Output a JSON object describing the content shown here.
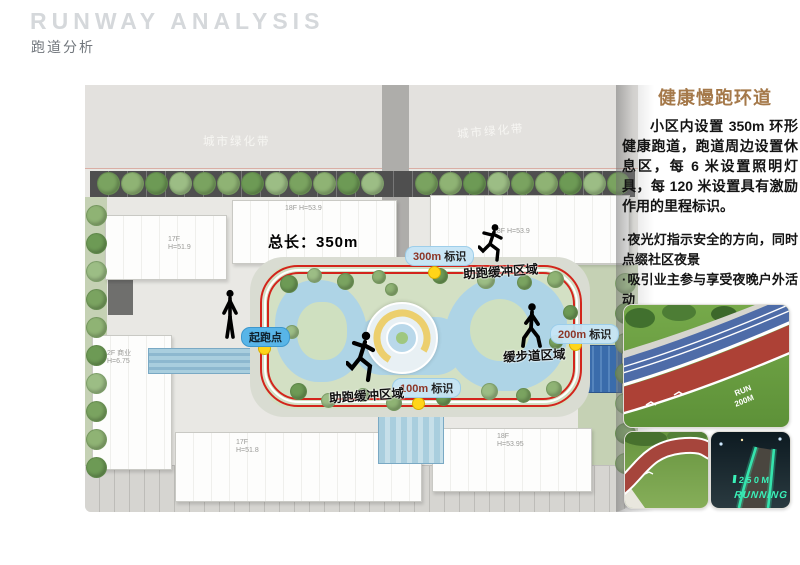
{
  "header": {
    "title_en": "RUNWAY ANALYSIS",
    "title_zh": "跑道分析"
  },
  "map": {
    "greenbelt_left": "城市绿化带",
    "greenbelt_right": "城市绿化带",
    "total_length": "总长：350m",
    "markers": {
      "m300": {
        "value": "300m",
        "text": "标识"
      },
      "m200": {
        "value": "200m",
        "text": "标识"
      },
      "m100": {
        "value": "100m",
        "text": "标识"
      },
      "start": "起跑点"
    },
    "zones": {
      "buffer_top": "助跑缓冲区域",
      "buffer_bottom": "助跑缓冲区域",
      "slow_lane": "缓步道区域"
    },
    "buildings": {
      "top_left": "17F\nH=51.9",
      "top_mid": "18F H=53.9",
      "top_right": "18F H=53.9",
      "left_commercial": "2F 商业\nH=6.75",
      "bottom_left": "17F\nH=51.8",
      "bottom_right": "18F\nH=53.95"
    }
  },
  "sidebar": {
    "heading": "健康慢跑环道",
    "paragraph": "小区内设置 350m 环形健康跑道，跑道周边设置休息区，每 6 米设置照明灯具，每 120 米设置具有激励作用的里程标识。",
    "bullets": [
      "夜光灯指示安全的方向，同时点缀社区夜景",
      "吸引业主参与享受夜晚户外活动",
      "沿路结合场地设置休息空间"
    ],
    "photo_day_text": {
      "run": "RUN",
      "dist": "200M"
    },
    "photo_night_text": {
      "dist": "250M",
      "word": "RUNNING"
    }
  },
  "colors": {
    "heading_accent": "#a5794a",
    "track_red": "#d3251c",
    "marker_yellow": "#ffd519",
    "pill_blue": "#c6e5f6",
    "start_pill_blue": "#58b5e8"
  }
}
